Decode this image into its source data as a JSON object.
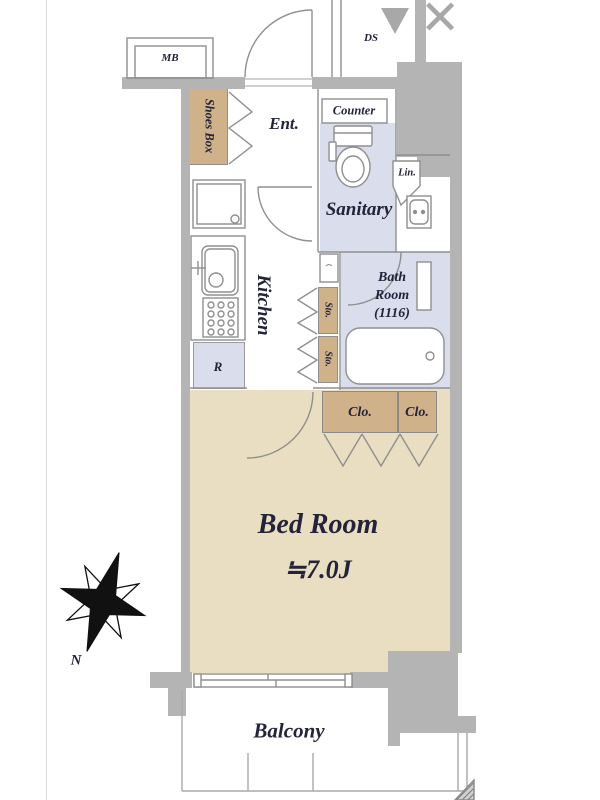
{
  "viewer": {
    "collapse_icon": "▼",
    "close_icon": "✕"
  },
  "floorplan": {
    "labels": {
      "mb": "MB",
      "ds": "DS",
      "shoes_box": "Shoes Box",
      "entrance": "Ent.",
      "counter": "Counter",
      "sanitary": "Sanitary",
      "linen": "Lin.",
      "kitchen": "Kitchen",
      "bath_line1": "Bath",
      "bath_line2": "Room",
      "bath_line3": "(1116)",
      "storage1": "Sto.",
      "storage2": "Sto.",
      "refrigerator": "R",
      "closet1": "Clo.",
      "closet2": "Clo.",
      "bedroom_name": "Bed Room",
      "bedroom_size": "≒7.0J",
      "balcony": "Balcony",
      "compass_north": "N"
    },
    "colors": {
      "wall_gray": "#b4b4b4",
      "storage_tan": "#cfb28a",
      "bedroom_tan": "#eadec2",
      "wet_area_lavender": "#dadeec",
      "label_ink": "#23233a"
    }
  }
}
